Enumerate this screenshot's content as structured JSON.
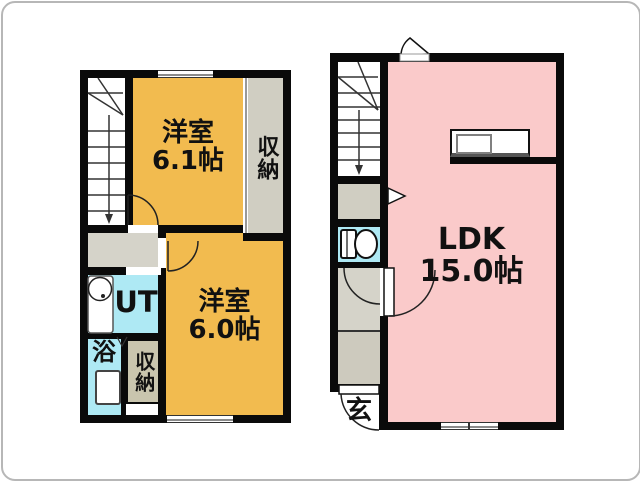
{
  "left_plan": {
    "room_61": {
      "name": "洋室",
      "size": "6.1帖"
    },
    "closet_upper": {
      "label": "収納"
    },
    "utility": {
      "label": "UT"
    },
    "bath": {
      "label": "浴"
    },
    "closet_lower": {
      "label": "収納"
    },
    "room_60": {
      "name": "洋室",
      "size": "6.0帖"
    }
  },
  "right_plan": {
    "ldk": {
      "name": "LDK",
      "size": "15.0帖"
    },
    "entrance": {
      "label": "玄"
    }
  },
  "colors": {
    "room_orange": "#F2BB4F",
    "ldk_pink": "#FACACA",
    "water_cyan": "#AEE9F4",
    "hall_gray": "#D5D3C9",
    "closet_gray": "#D0CEC2",
    "closet_tan": "#C9C5AE",
    "entry_gray": "#CDCABE",
    "wall_black": "#0A0A0A"
  }
}
